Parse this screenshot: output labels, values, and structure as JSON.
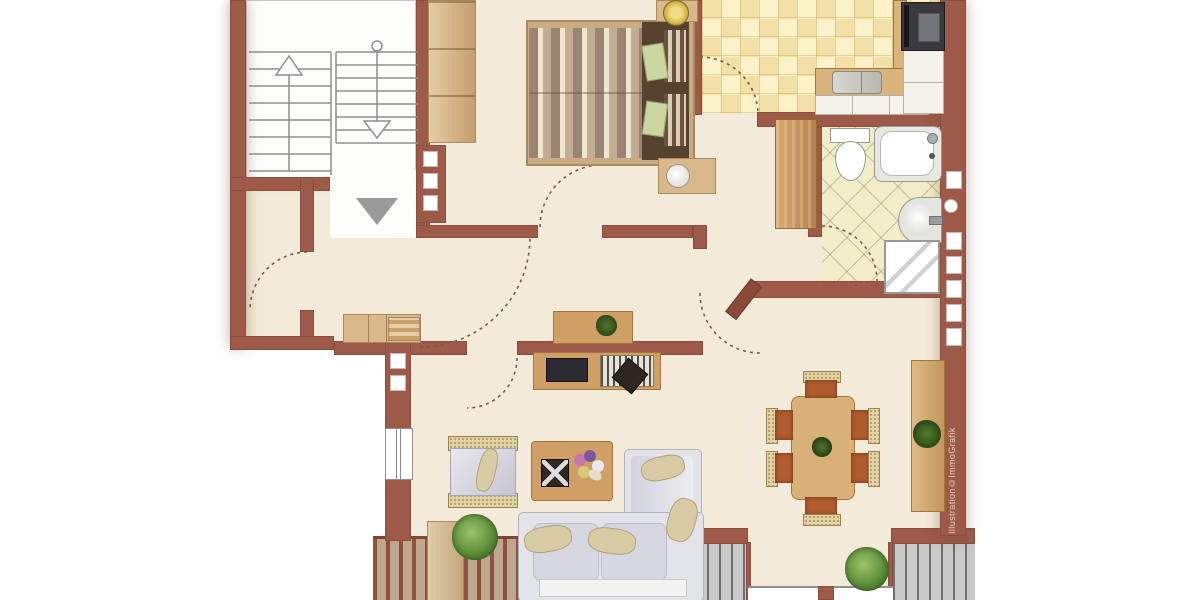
{
  "watermark": {
    "text": "Illustration©ImmoGrafik"
  },
  "colors": {
    "wall": "#9d5a48",
    "floor": "#f3ead9",
    "kitchen_tile": "#f6e8b4",
    "bath_tile": "#f2edc8",
    "wood": "#cf9f66",
    "wood_light": "#d9b98c",
    "deck_stripe": "#8f523f",
    "deck_gap": "#bfa68f",
    "gray_deck": "#c9c9c9",
    "sofa": "#e3e3ea",
    "cushion": "#d9cba4",
    "chair_seat": "#b05c2e",
    "wicker": "#e3d2a4",
    "plant_green": "#5d8f3a",
    "entrance_arrow": "#9a9a9a",
    "stove_dark": "#3a3a3e",
    "tv_dark": "#2a2a30"
  },
  "plan": {
    "type": "apartment-floor-plan",
    "rooms": [
      {
        "name": "stairwell",
        "features": [
          "stairs-up-arrow",
          "stairs-down-arrow",
          "entrance-direction-arrow"
        ]
      },
      {
        "name": "bedroom",
        "furniture": [
          "double-bed",
          "wardrobe",
          "nightstand-with-lamp",
          "nightstand-with-bowl"
        ]
      },
      {
        "name": "kitchen",
        "furniture": [
          "stove",
          "sink",
          "l-shaped-counter",
          "cabinets"
        ]
      },
      {
        "name": "bathroom",
        "furniture": [
          "toilet",
          "bathtub",
          "washbasin",
          "shower"
        ]
      },
      {
        "name": "hallway",
        "furniture": [
          "tall-cabinet",
          "sideboard",
          "desk-with-plant"
        ]
      },
      {
        "name": "storage-room",
        "furniture": []
      },
      {
        "name": "living-room",
        "furniture": [
          "corner-sofa",
          "armchair",
          "coffee-table",
          "tv-lowboard",
          "reading-chair",
          "plant"
        ]
      },
      {
        "name": "dining-area",
        "furniture": [
          "dining-table",
          "chairs-x6",
          "sideboard-with-plant",
          "plant"
        ]
      },
      {
        "name": "balcony",
        "furniture": [
          "plant"
        ]
      }
    ]
  }
}
